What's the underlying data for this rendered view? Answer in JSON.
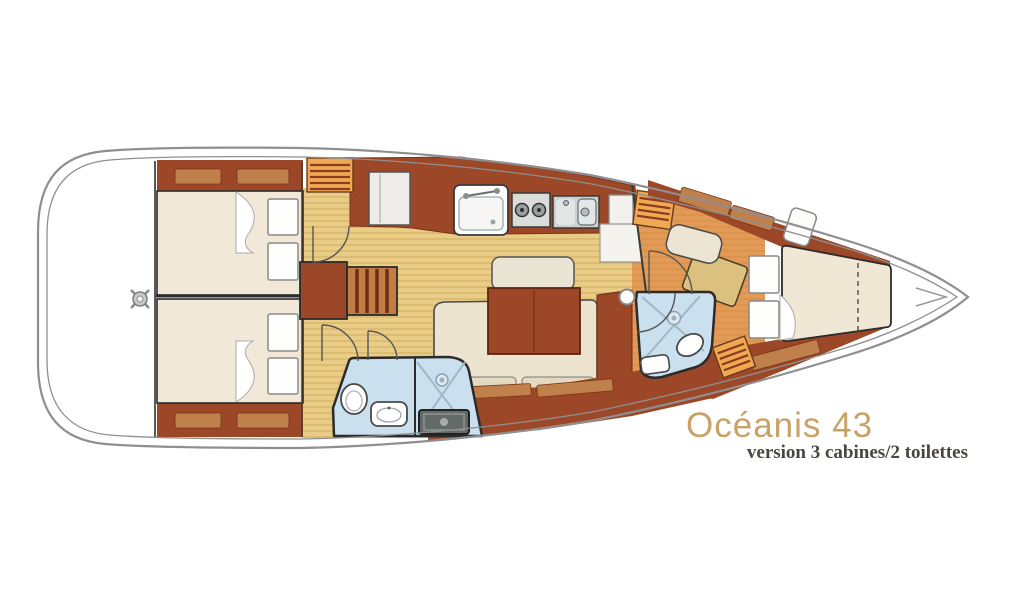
{
  "plan": {
    "title": "Océanis 43",
    "subtitle": "version 3 cabines/2 toilettes"
  },
  "colors": {
    "background": "#FFFFFF",
    "title_text": "#C9A268",
    "subtitle_text": "#4A453F",
    "hull_line": "#8F8F8F",
    "wood_dark": "#9C4727",
    "wood_light": "#C0804C",
    "upholstery_cream": "#F0E6D4",
    "floor_tan": "#E9CD86",
    "floor_orange": "#E29B57",
    "bathroom_blue": "#CBE0EE",
    "locker_orange": "#EFA953"
  }
}
